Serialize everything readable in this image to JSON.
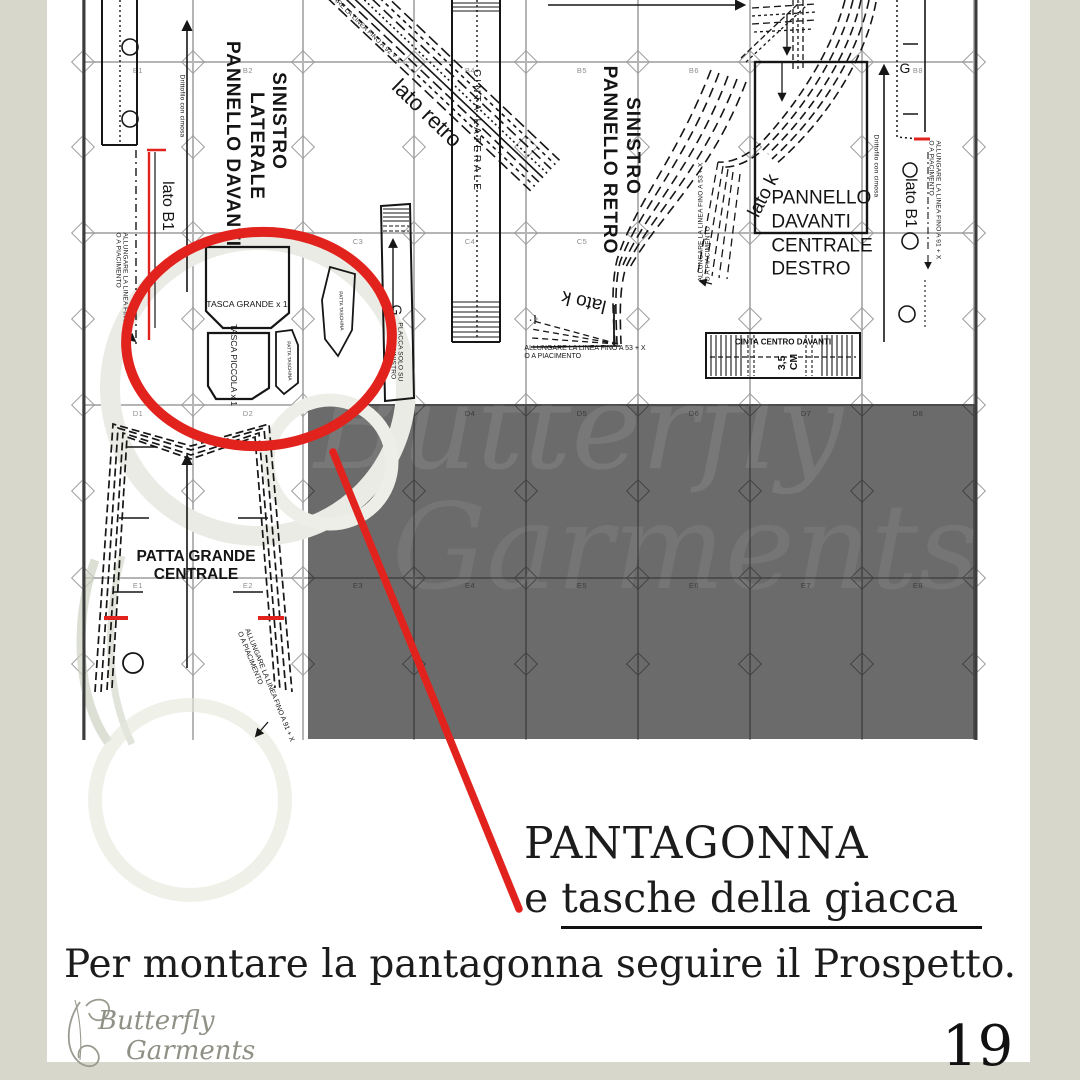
{
  "page": {
    "background": "#d7d7cc",
    "paper": "#ffffff",
    "accent_red": "#e2231d",
    "gray_panel": "#6b6b6b"
  },
  "caption": {
    "title": "PANTAGONNA",
    "subtitle_prefix": "e ",
    "subtitle_underlined": "tasche della giacca",
    "body": "Per montare la pantagonna seguire il Prospetto.",
    "page_number": "19"
  },
  "logo": {
    "line1": "Butterfly",
    "line2": "Garments"
  },
  "watermark": {
    "line1": "Butterfly",
    "line2": "Garments"
  },
  "sheet": {
    "grid": {
      "col_lines": [
        83,
        193,
        303,
        414,
        526,
        638,
        750,
        862,
        974
      ],
      "row_lines": [
        62,
        233,
        405,
        578
      ],
      "diamond_ys": [
        62,
        147,
        233,
        319,
        405,
        491,
        578,
        664
      ],
      "labels": [
        {
          "t": "B1",
          "x": 138,
          "y": 66
        },
        {
          "t": "B2",
          "x": 248,
          "y": 66
        },
        {
          "t": "B4",
          "x": 470,
          "y": 66
        },
        {
          "t": "B5",
          "x": 582,
          "y": 66
        },
        {
          "t": "B6",
          "x": 694,
          "y": 66
        },
        {
          "t": "B8",
          "x": 918,
          "y": 66
        },
        {
          "t": "C2",
          "x": 248,
          "y": 237
        },
        {
          "t": "C3",
          "x": 358,
          "y": 237
        },
        {
          "t": "C4",
          "x": 470,
          "y": 237
        },
        {
          "t": "C5",
          "x": 582,
          "y": 237
        },
        {
          "t": "C7",
          "x": 806,
          "y": 237
        },
        {
          "t": "D1",
          "x": 138,
          "y": 409
        },
        {
          "t": "D2",
          "x": 248,
          "y": 409
        },
        {
          "t": "D4",
          "x": 470,
          "y": 409
        },
        {
          "t": "D5",
          "x": 582,
          "y": 409
        },
        {
          "t": "D6",
          "x": 694,
          "y": 409
        },
        {
          "t": "D7",
          "x": 806,
          "y": 409
        },
        {
          "t": "D8",
          "x": 918,
          "y": 409
        },
        {
          "t": "E1",
          "x": 138,
          "y": 581
        },
        {
          "t": "E2",
          "x": 248,
          "y": 581
        },
        {
          "t": "E3",
          "x": 358,
          "y": 581
        },
        {
          "t": "E4",
          "x": 470,
          "y": 581
        },
        {
          "t": "E5",
          "x": 582,
          "y": 581
        },
        {
          "t": "E6",
          "x": 694,
          "y": 581
        },
        {
          "t": "E7",
          "x": 806,
          "y": 581
        },
        {
          "t": "E8",
          "x": 918,
          "y": 581
        }
      ]
    },
    "labels": {
      "pannello_davanti_laterale_1": "PANNELLO DAVANTI",
      "pannello_davanti_laterale_2": "LATERALE",
      "pannello_davanti_laterale_3": "SINISTRO",
      "lato_retro": "lato retro",
      "allungare_92": "ALLUNGARE LA LINEA FINO A 92 + X",
      "cinta_laterale": "CINTA LATERALE",
      "pannello_retro_1": "PANNELLO RETRO",
      "pannello_retro_2": "SINISTRO",
      "lato_k": "lato k",
      "allungare_53": "ALLUNGARE LA LINEA FINO A 53 + X\nO A PIACIMENTO",
      "pannello_centrale": "PANNELLO\nDAVANTI\nCENTRALE\nDESTRO",
      "drittofilo": "Drittofilo con cimosa",
      "g": "G",
      "lato_b1": "lato B1",
      "allungare_91": "ALLUNGARE LA LINEA FINO A 91 + X\nO A PIACIMENTO",
      "placca": "PLACCA SOLO SU\nPEZZO SINISTRO",
      "cinta_centro": "CINTA CENTRO DAVANTI",
      "misura": "3,5\nCM",
      "tasca_grande": "TASCA GRANDE x 1",
      "tasca_piccola": "TASCA PICCOLA x 1",
      "patta_taschina": "PATTA TASCHINA",
      "patta_grande": "PATTA GRANDE\nCENTRALE"
    }
  }
}
